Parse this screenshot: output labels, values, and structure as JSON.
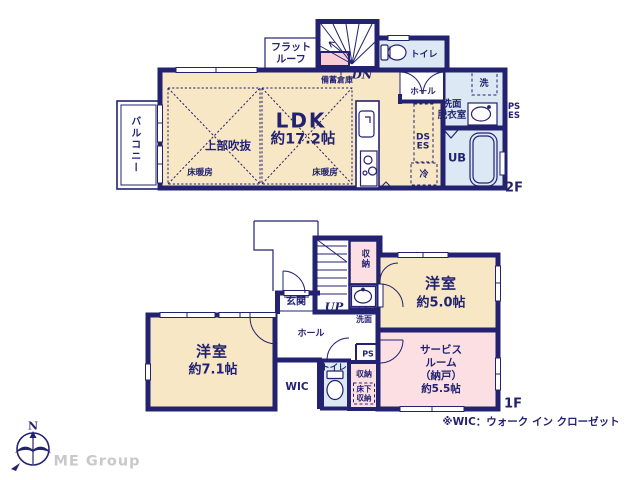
{
  "document_type": "floor-plan",
  "colors": {
    "wall": "#232271",
    "text": "#232271",
    "cream": "#f7e7c5",
    "pink": "#fbdfe2",
    "pinkdeep": "#f6ced4",
    "blue": "#dce8f4",
    "brandgray": "#c9c9cd"
  },
  "labels": {
    "f2": {
      "floor_label": "2F",
      "balcony": "バルコニー",
      "flat_roof": "フラット\nルーフ",
      "stock_storage": "備蓄倉庫",
      "stairs_down": "DN",
      "toilet": "トイレ",
      "hall": "ホール",
      "ldk_name": "LDK",
      "ldk_size": "約17.2帖",
      "void_label": "上部吹抜",
      "floor_heating_left": "床暖房",
      "floor_heating_right": "床暖房",
      "washer": "洗",
      "washroom": "洗面\n脱衣室",
      "ps_es": "PS\nES",
      "ds_es": "DS\nES",
      "unit_bath": "UB",
      "fridge": "冷"
    },
    "f1": {
      "floor_label": "1F",
      "entrance": "玄関",
      "stairs_up": "UP",
      "storage_upper": "収納",
      "second_basin": "セカンド\n洗面",
      "hall": "ホール",
      "bedroom_left_name": "洋室",
      "bedroom_left_size": "約7.1帖",
      "wic": "WIC",
      "toilet": "トイレ",
      "ps": "PS",
      "storage_lower": "収納",
      "underfloor_storage": "床下\n収納",
      "bedroom_right_name": "洋室",
      "bedroom_right_size": "約5.0帖",
      "service_room": "サービス\nルーム\n（納戸）\n約5.5帖"
    },
    "footer": {
      "wic_note": "※WIC：ウォーク イン クローゼット",
      "compass_north": "N",
      "brand": "ME Group"
    }
  }
}
